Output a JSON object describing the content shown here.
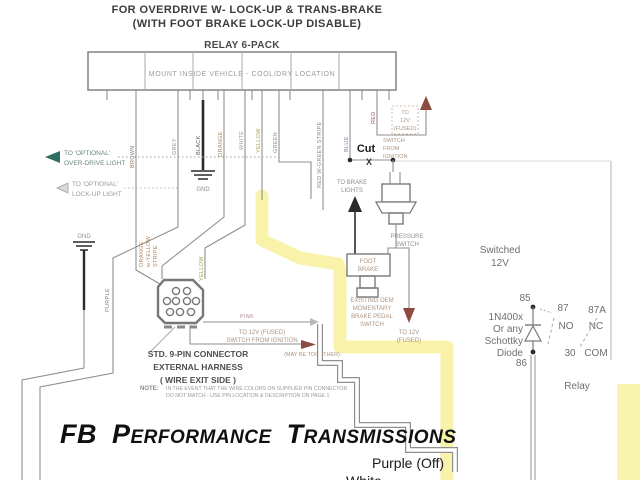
{
  "title": {
    "line1": "FOR OVERDRIVE W- LOCK-UP & TRANS-BRAKE",
    "line2": "(WITH FOOT BRAKE LOCK-UP DISABLE)"
  },
  "relay_pack": {
    "title": "RELAY 6-PACK",
    "mount_note": "MOUNT INSIDE VEHICLE - COOL/DRY LOCATION"
  },
  "wires": {
    "brown": "BROWN",
    "grey": "GREY",
    "black": "BLACK",
    "orange": "ORANGE",
    "white": "WHITE",
    "yellow": "YELLOW",
    "green": "GREEN",
    "red_green_stripe": "RED W-GREEN STRIPE",
    "blue": "BLUE",
    "red": "RED",
    "purple": "PURPLE",
    "pink": "PINK",
    "yellow2": "YELLOW",
    "orange_stripe_1": "ORANGE",
    "orange_stripe_2": "w-YELLOW",
    "orange_stripe_3": "STRIPE"
  },
  "left_outputs": {
    "overdrive_1": "TO 'OPTIONAL'",
    "overdrive_2": "OVER-DRIVE LIGHT",
    "lockup_1": "TO 'OPTIONAL'",
    "lockup_2": "LOCK-UP LIGHT"
  },
  "grounds": {
    "gnd_left": "GND",
    "gnd_center": "GND"
  },
  "cut": {
    "label": "Cut",
    "x_mark": "X"
  },
  "ign_feed_top": {
    "l1": "TO",
    "l2": "12V",
    "l3": "(FUSED)",
    "s1": "SWITCH",
    "s2": "FROM",
    "s3": "IGNITION"
  },
  "brake_lights": {
    "l1": "TO BRAKE",
    "l2": "LIGHTS"
  },
  "pressure_switch": {
    "l1": "PRESSURE",
    "l2": "SWITCH"
  },
  "foot_brake": {
    "l1": "FOOT",
    "l2": "BRAKE"
  },
  "oem_switch": {
    "l1": "EXISTING OEM",
    "l2": "MOMENTARY",
    "l3": "BRAKE PEDAL",
    "l4": "SWITCH"
  },
  "down_12v": {
    "l1": "TO 12V",
    "l2": "(FUSED)"
  },
  "pink_feed": {
    "l1": "TO 12V (FUSED)",
    "l2": "SWITCH FROM IGNITION",
    "together": "(MAY BE TOGETHER)"
  },
  "connector_callout": {
    "l1": "STD. 9-PIN CONNECTOR",
    "l2": "EXTERNAL HARNESS",
    "l3": "( WIRE EXIT SIDE )"
  },
  "note": {
    "prefix": "NOTE:",
    "l1": "IN THE EVENT THAT THE WIRE COLORS ON SUPPLIED PIN CONNECTOR",
    "l2": "DO NOT MATCH - USE PIN LOCATION & DESCRIPTION ON PAGE 1"
  },
  "relay": {
    "switched_1": "Switched",
    "switched_2": "12V",
    "pin85": "85",
    "pin86": "86",
    "pin87": "87",
    "pin87a": "87A",
    "pin30": "30",
    "no": "NO",
    "nc": "NC",
    "com": "COM",
    "label": "Relay",
    "diode_1": "1N400x",
    "diode_2": "Or any",
    "diode_3": "Schottky",
    "diode_4": "Diode"
  },
  "footer": {
    "brand": "FB Performance Transmissions",
    "purple_off": "Purple (Off)",
    "clipped_label": "White"
  },
  "colors": {
    "highlight": "#f7ef96",
    "arrow_red": "#8e4a42",
    "arrow_teal": "#2f6e62",
    "wire_grey": "#8f8f8f"
  }
}
